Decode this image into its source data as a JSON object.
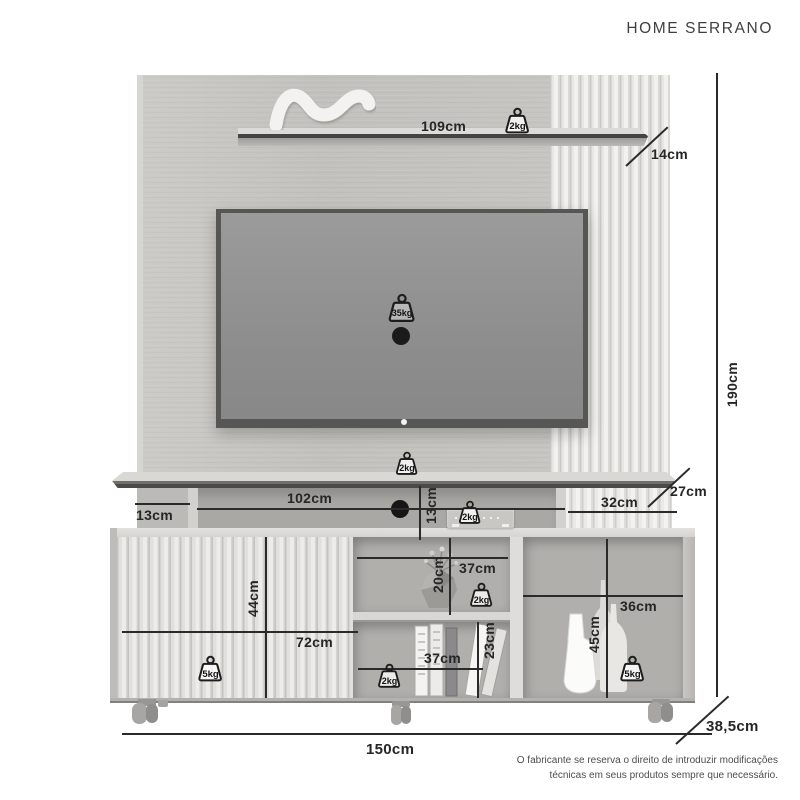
{
  "title": "HOME SERRANO",
  "dimensions": {
    "top_shelf_length": "109cm",
    "top_shelf_depth": "14cm",
    "total_height": "190cm",
    "panel_shelf_depth": "27cm",
    "left_niche_height": "13cm",
    "console_niche_width": "102cm",
    "console_niche_height": "13cm",
    "right_niche_width": "32cm",
    "door_section_height": "44cm",
    "door_section_width": "72cm",
    "middle_top_niche_width": "37cm",
    "middle_top_niche_height": "20cm",
    "middle_bottom_niche_width": "37cm",
    "middle_bottom_niche_height": "23cm",
    "right_compartment_width": "36cm",
    "right_compartment_height": "45cm",
    "total_width": "150cm",
    "total_depth": "38,5cm"
  },
  "weights": {
    "top_shelf": "2kg",
    "tv": "35kg",
    "panel_shelf": "2kg",
    "console": "2kg",
    "door": "5kg",
    "middle_top": "2kg",
    "middle_bottom": "2kg",
    "right": "5kg"
  },
  "disclaimer": {
    "line1": "O fabricante se reserva o direito de introduzir modificações",
    "line2": "técnicas em seus produtos sempre que necessário."
  },
  "colors": {
    "dimension_ink": "#2a2a2a",
    "panel_wood": "#c6c4c0",
    "slat_light": "#eceae7",
    "cabinet_body": "#d3d2cf",
    "tv_screen": "#919191"
  }
}
